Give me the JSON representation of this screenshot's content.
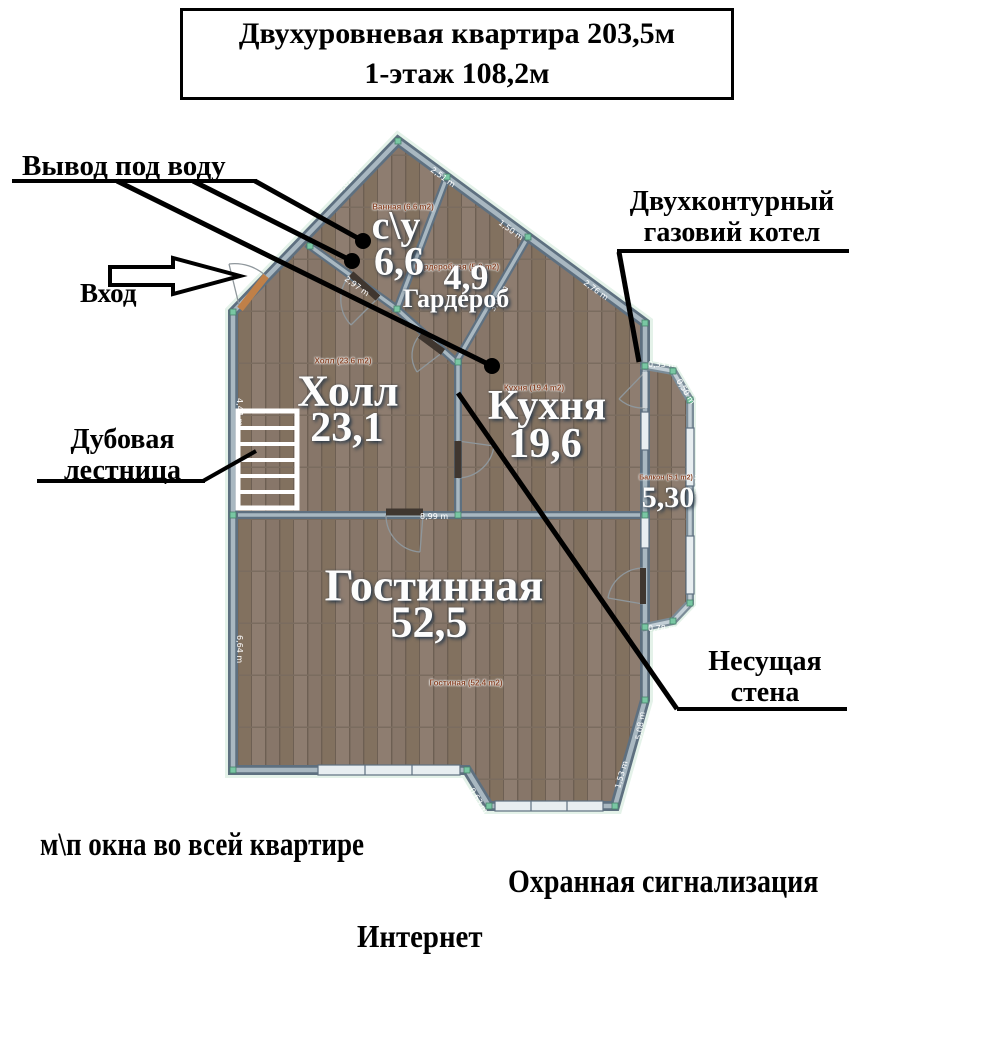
{
  "title": {
    "line1": "Двухуровневая квартира 203,5м",
    "line2": "1-этаж 108,2м"
  },
  "rooms": {
    "bathroom": {
      "label": "с\\у",
      "area": "6,6",
      "sublabel": "Ванная (6.6 m2)"
    },
    "wardrobe": {
      "area": "4,9",
      "label": "Гардероб",
      "sublabel": "Гардеробная (5.0 m2)"
    },
    "hall": {
      "label": "Холл",
      "area": "23,1",
      "sublabel": "Холл (23.6 m2)"
    },
    "kitchen": {
      "label": "Кухня",
      "area": "19,6",
      "sublabel": "Кухня (19.4 m2)"
    },
    "living": {
      "label": "Гостинная",
      "area": "52,5",
      "sublabel": "Гостиная (52.4 m2)"
    },
    "balcony": {
      "area": "5,30",
      "sublabel": "Балкон (5.1 m2)"
    }
  },
  "annotations": {
    "water_outlet": "Вывод под воду",
    "entrance": "Вход",
    "boiler": {
      "line1": "Двухконтурный",
      "line2": "газовий котел"
    },
    "stairs": {
      "line1": "Дубовая",
      "line2": "лестница"
    },
    "bearing_wall": {
      "line1": "Несущая",
      "line2": "стена"
    }
  },
  "notes": {
    "windows": "м\\п окна во всей квартире",
    "alarm": "Охранная сигнализация",
    "internet": "Интернет"
  },
  "wall_dimensions": [
    "3,02 m",
    "2,51 m",
    "1,50 m",
    "2,76 m",
    "3,07 m",
    "2,97 m",
    "8,99 m",
    "0,33 m",
    "0,50 m",
    "4,98 m",
    "0,78 m",
    "5,08 m",
    "1,53 m",
    "0,63 m",
    "6,64 m",
    "4,44 m"
  ],
  "colors": {
    "floor_wood": "#877669",
    "wall": "#5e7080",
    "wall_highlight": "#a9b8c1",
    "node_marker": "#79c7a3",
    "door_dark": "#3f362f",
    "entrance_door": "#c08048",
    "room_label": "#ffffff",
    "room_sublabel": "#8a4a2e",
    "annotation": "#000000"
  }
}
